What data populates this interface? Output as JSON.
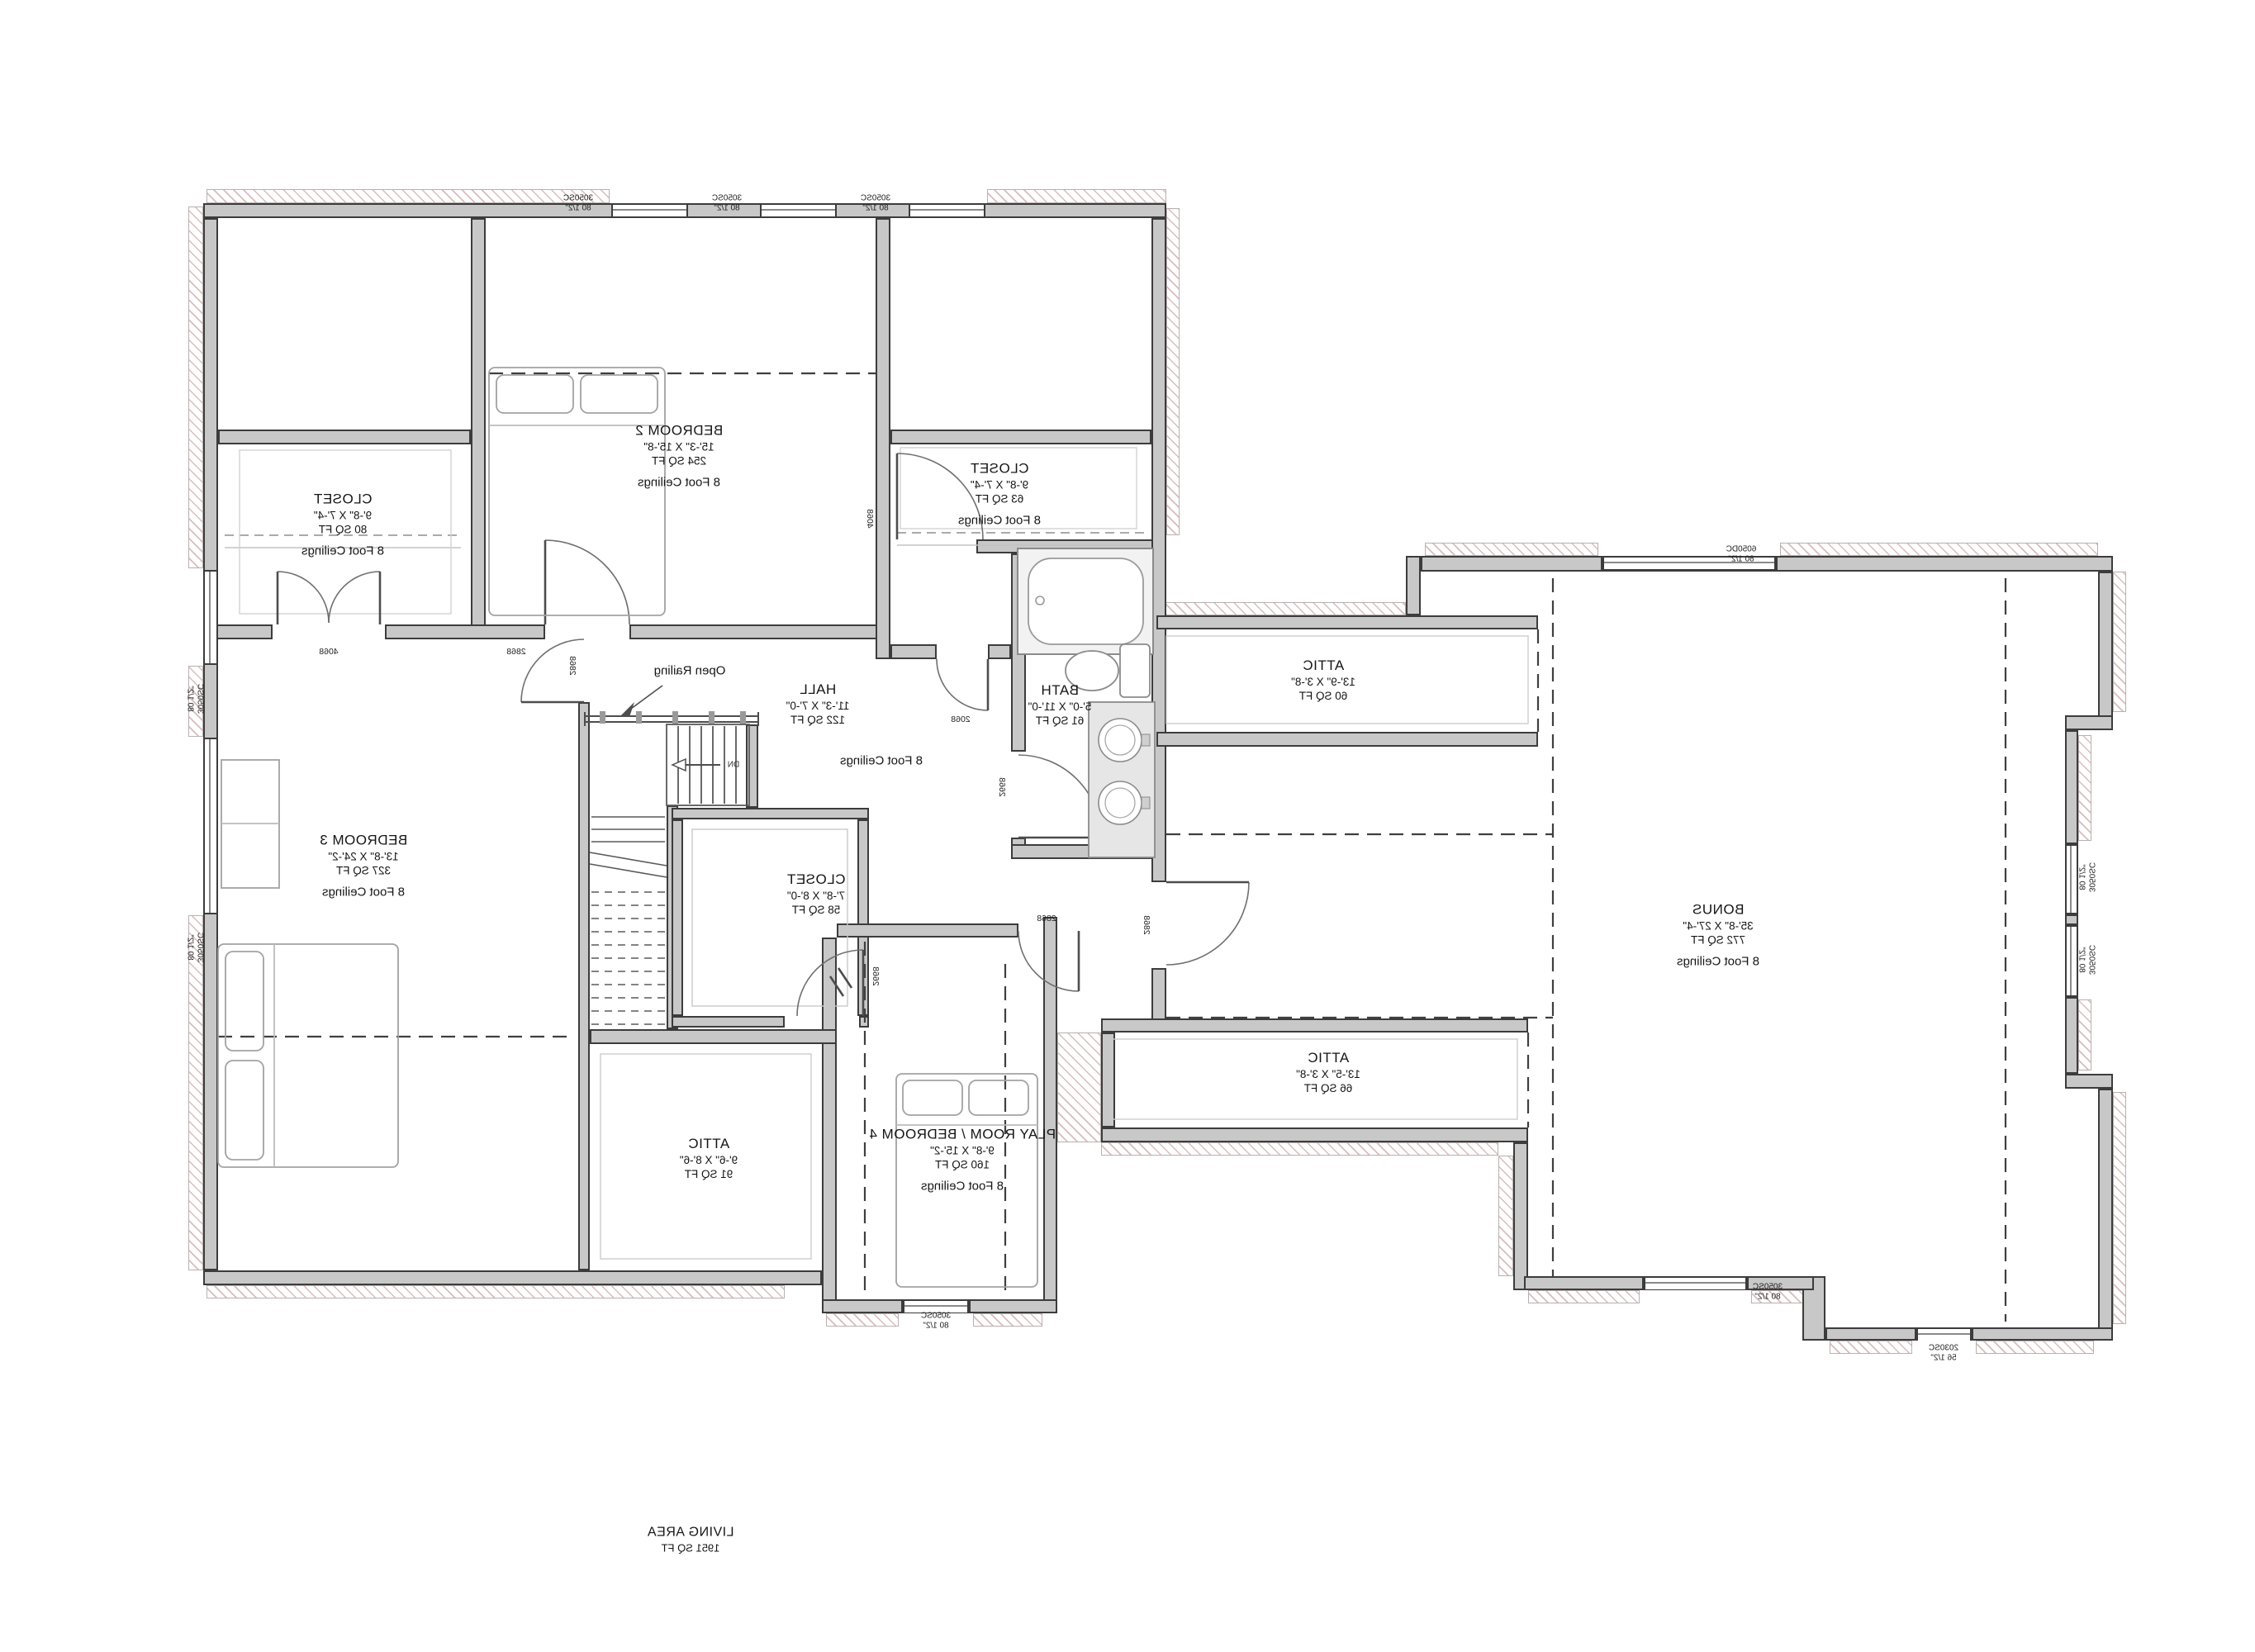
{
  "rooms": {
    "bedroom2": {
      "name": "BEDROOM 2",
      "dims": "15'-3\" X 15'-8\"",
      "area": "254 SQ FT",
      "ceiling": "8 Foot Ceilings"
    },
    "closet_b2": {
      "name": "CLOSET",
      "dims": "9'-8\" X 7'-4\"",
      "area": "80 SQ FT",
      "ceiling": "8 Foot Ceilings"
    },
    "closet_hall": {
      "name": "CLOSET",
      "dims": "9'-8\" X 7'-4\"",
      "area": "63 SQ FT",
      "ceiling": "8 Foot Ceilings"
    },
    "bath": {
      "name": "BATH",
      "dims": "5'-0\" X 11'-0\"",
      "area": "61 SQ FT"
    },
    "hall": {
      "name": "HALL",
      "dims": "11'-3\" X 7'-0\"",
      "area": "122 SQ FT",
      "ceiling": "8 Foot Ceilings"
    },
    "bedroom3": {
      "name": "BEDROOM 3",
      "dims": "13'-8\" X 24'-2\"",
      "area": "327 SQ FT",
      "ceiling": "8 Foot Ceilings"
    },
    "closet58": {
      "name": "CLOSET",
      "dims": "7'-8\" X 8'-0\"",
      "area": "58 SQ FT"
    },
    "attic_top": {
      "name": "ATTIC",
      "dims": "13'-9\" X 3'-8\"",
      "area": "60 SQ FT"
    },
    "attic_bottom": {
      "name": "ATTIC",
      "dims": "13'-5\" X 3'-8\"",
      "area": "66 SQ FT"
    },
    "attic_left": {
      "name": "ATTIC",
      "dims": "9'-6\" X 8'-6\"",
      "area": "91 SQ FT"
    },
    "bonus": {
      "name": "BONUS",
      "dims": "35'-8\" X 27'-4\"",
      "area": "772 SQ FT",
      "ceiling": "8 Foot Ceilings"
    },
    "playroom": {
      "name": "PLAY ROOM / BEDROOM 4",
      "dims": "9'-8\" X 15'-2\"",
      "area": "160 SQ FT",
      "ceiling": "8 Foot Ceilings"
    }
  },
  "summary": {
    "label": "LIVING AREA",
    "value": "1951 SQ FT"
  },
  "annotations": {
    "open_railing": "Open Railing",
    "down": "DN"
  },
  "door_codes": {
    "closet_b2_doors": "4068",
    "closet_hall_door": "4068",
    "bedroom2_door": "2868",
    "bedroom3_door": "2868",
    "toilet_door": "2068",
    "bath_door": "2668",
    "closet58_door": "2668",
    "playroom_door": "2868",
    "bonus_door": "2868"
  },
  "window_codes": {
    "top_1": {
      "model": "3050SC",
      "width": "80 1/2\""
    },
    "top_2": {
      "model": "3050SC",
      "width": "80 1/2\""
    },
    "top_3": {
      "model": "3050SC",
      "width": "80 1/2\""
    },
    "left_1": {
      "model": "3050SC",
      "width": "80 1/2\""
    },
    "left_2": {
      "model": "3050SC",
      "width": "80 1/2\""
    },
    "playroom_s": {
      "model": "3050SC",
      "width": "80 1/2\""
    },
    "bonus_n": {
      "model": "6050DC",
      "width": "80 1/2\""
    },
    "bonus_e1": {
      "model": "3050SC",
      "width": "80 1/2\""
    },
    "bonus_e2": {
      "model": "3050SC",
      "width": "80 1/2\""
    },
    "bonus_sw": {
      "model": "3050SC",
      "width": "80 1/2\""
    },
    "bonus_se": {
      "model": "2030SC",
      "width": "56 1/2\""
    }
  },
  "colors": {
    "wall_fill": "#c8c8c8",
    "wall_edge": "#3c3c3c",
    "hatch_line": "#d9bcbc",
    "text": "#151515"
  }
}
